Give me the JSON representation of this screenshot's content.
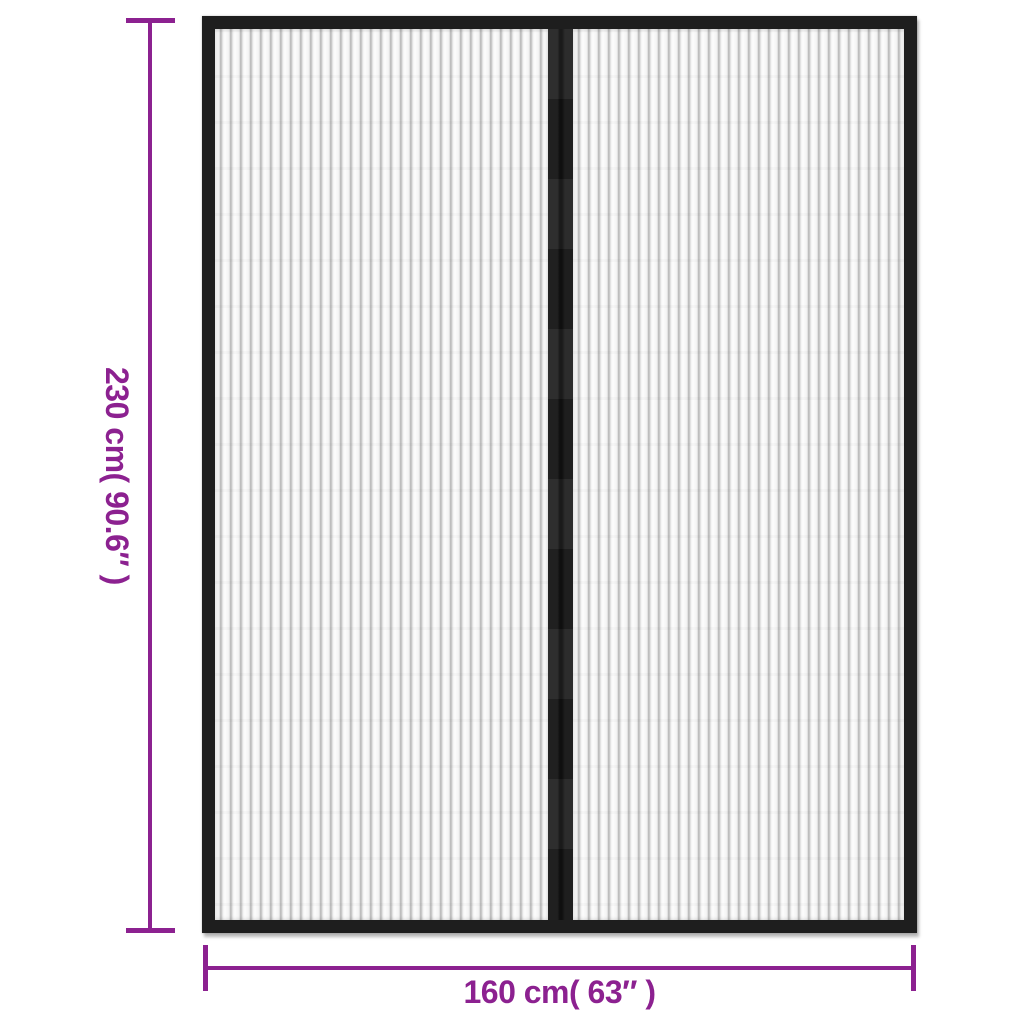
{
  "diagram": {
    "kind": "product-dimension-diagram",
    "product": "magnetic-insect-screen-door-curtain-2-panels-black"
  },
  "dimensions": {
    "height_label": "230 cm( 90.6″ )",
    "width_label": "160 cm( 63″ )"
  },
  "colors": {
    "dimension_accent": "#8C2190",
    "frame": "#1E1E1E",
    "mesh_background": "#F8F8F8",
    "mesh_stripe": "#B4B4B4",
    "background": "#FFFFFF"
  }
}
